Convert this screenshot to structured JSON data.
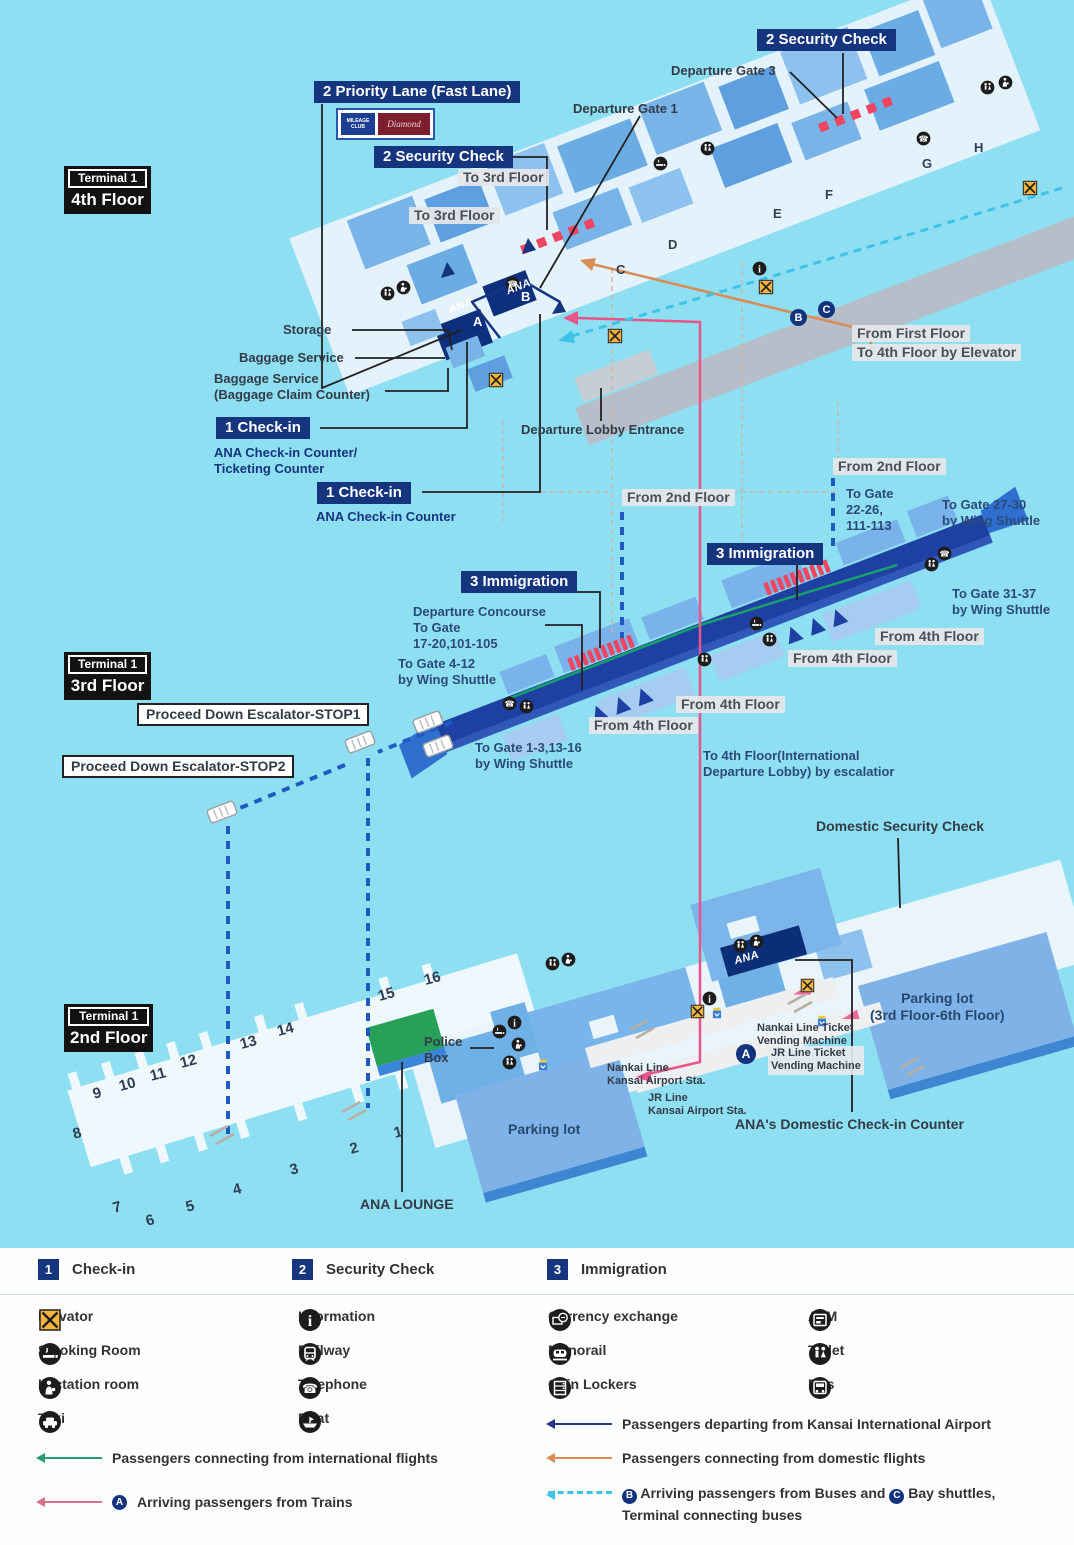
{
  "colors": {
    "background": "#8edff2",
    "label_navy": "#15357f",
    "building_blue": "#77b3e9",
    "route_departing": "#27348b",
    "route_international": "#2a9a72",
    "route_domestic": "#d98c55",
    "route_trains": "#e8558a",
    "route_buses": "#3fc3e8",
    "security_red": "#ef4560",
    "lounge_green": "#27a05a",
    "elevator_yellow": "#f2b43c"
  },
  "floors": [
    {
      "terminal": "Terminal 1",
      "floor": "4th Floor"
    },
    {
      "terminal": "Terminal 1",
      "floor": "3rd Floor"
    },
    {
      "terminal": "Terminal 1",
      "floor": "2nd Floor"
    }
  ],
  "map": {
    "labels": {
      "sec_check": "2 Security Check",
      "priority_lane": "2 Priority Lane (Fast Lane)",
      "checkin": "1 Check-in",
      "checkin_sub_a": [
        "ANA Check-in Counter/",
        "Ticketing Counter"
      ],
      "checkin_sub_b": "ANA Check-in Counter",
      "immigration": "3 Immigration",
      "departure_gate_3": "Departure Gate 3",
      "departure_gate_1": "Departure Gate 1",
      "to_3rd_floor": "To 3rd Floor",
      "storage": "Storage",
      "baggage_service": "Baggage Service",
      "baggage_claim": [
        "Baggage Service",
        "(Baggage Claim Counter)"
      ],
      "departure_lobby_entrance": "Departure Lobby Entrance",
      "from_first_floor": [
        "From First Floor",
        "To 4th Floor by Elevator"
      ],
      "from_2nd_floor": "From 2nd Floor",
      "from_4th_floor": "From 4th Floor",
      "to_gate_22": [
        "To Gate",
        "22-26,",
        "111-113"
      ],
      "to_gate_27_30": [
        "To Gate 27-30",
        "by Wing Shuttle"
      ],
      "to_gate_31_37": [
        "To Gate 31-37",
        "by Wing Shuttle"
      ],
      "departure_concourse": [
        "Departure Concourse",
        "To Gate",
        "17-20,101-105"
      ],
      "to_gate_4_12": [
        "To Gate 4-12",
        "by Wing Shuttle"
      ],
      "to_gate_1_3": [
        "To Gate 1-3,13-16",
        "by Wing Shuttle"
      ],
      "stop1": "Proceed Down Escalator-STOP1",
      "stop2": "Proceed Down Escalator-STOP2",
      "to_4th_floor_intl": [
        "To 4th Floor(International",
        "Departure Lobby) by escalatior"
      ],
      "domestic_security": "Domestic Security Check",
      "police_box": [
        "Police",
        "Box"
      ],
      "parking_lot": "Parking lot",
      "parking_lot_floors": [
        "Parking lot",
        "(3rd Floor-6th Floor)"
      ],
      "nankai_tvm": [
        "Nankai Line Ticket",
        "Vending Machine"
      ],
      "jr_tvm": [
        "JR Line Ticket",
        "Vending Machine"
      ],
      "nankai_sta": [
        "Nankai Line",
        "Kansai Airport Sta."
      ],
      "jr_sta": [
        "JR Line",
        "Kansai Airport Sta."
      ],
      "ana_domestic": "ANA's Domestic Check-in Counter",
      "ana_lounge": "ANA LOUNGE"
    },
    "gates": [
      "1",
      "2",
      "3",
      "4",
      "5",
      "6",
      "7",
      "8",
      "9",
      "10",
      "11",
      "12",
      "13",
      "14",
      "15",
      "16"
    ],
    "buildings": [
      "A",
      "B",
      "C",
      "D",
      "E",
      "F",
      "G",
      "H"
    ],
    "badges": {
      "a": "A",
      "b": "B",
      "c": "C"
    },
    "ana": "ANA",
    "priority_badges": {
      "blue": "MILEAGE CLUB",
      "red": "Diamond"
    }
  },
  "legend": {
    "steps": [
      {
        "num": "1",
        "label": "Check-in"
      },
      {
        "num": "2",
        "label": "Security Check"
      },
      {
        "num": "3",
        "label": "Immigration"
      }
    ],
    "facilities": [
      {
        "icon": "elevator",
        "label": "Elevator"
      },
      {
        "icon": "information",
        "label": "Information"
      },
      {
        "icon": "currency-exchange",
        "label": "Currency exchange"
      },
      {
        "icon": "atm",
        "label": "ATM"
      },
      {
        "icon": "smoking-room",
        "label": "Smoking Room"
      },
      {
        "icon": "railway",
        "label": "Railway"
      },
      {
        "icon": "monorail",
        "label": "Monorail"
      },
      {
        "icon": "toilet",
        "label": "Toilet"
      },
      {
        "icon": "lactation-room",
        "label": "Lactation room"
      },
      {
        "icon": "telephone",
        "label": "Telephone"
      },
      {
        "icon": "coin-lockers",
        "label": "Coin Lockers"
      },
      {
        "icon": "bus",
        "label": "Bus"
      },
      {
        "icon": "taxi",
        "label": "Taxi"
      },
      {
        "icon": "boat",
        "label": "Boat"
      }
    ],
    "routes": {
      "departing": "Passengers departing from Kansai International Airport",
      "intl_connect": "Passengers connecting from international flights",
      "dom_connect": "Passengers connecting from domestic flights",
      "trains": "Arriving passengers from Trains",
      "buses_1": "Arriving passengers from Buses and",
      "buses_2": "Bay shuttles, Terminal connecting buses"
    }
  }
}
